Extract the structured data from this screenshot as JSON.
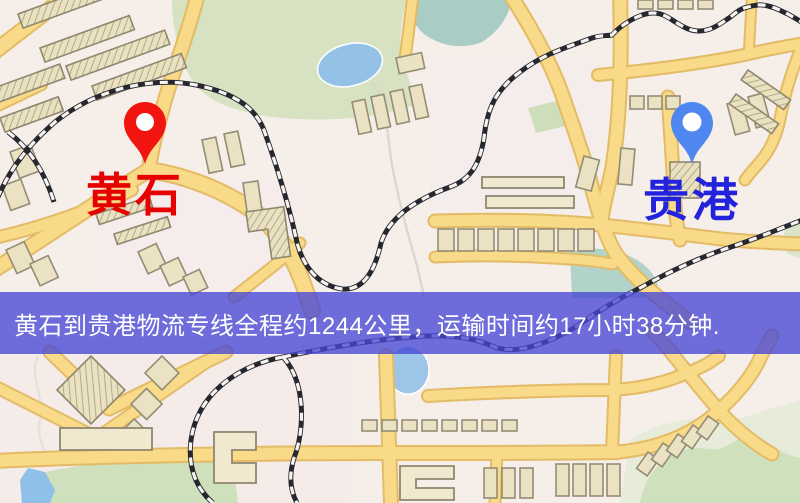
{
  "banner": {
    "text": "黄石到贵港物流专线全程约1244公里，运输时间约17小时38分钟.",
    "background_color": "#4646d6",
    "text_color": "#ffffff"
  },
  "origin": {
    "label": "黄石",
    "pin_color": "#f21410",
    "label_color": "#e60000"
  },
  "destination": {
    "label": "贵港",
    "pin_color": "#4f86f0",
    "label_color": "#2323dd"
  },
  "map_colors": {
    "background": "#f6efe9",
    "road_fill": "#f8da88",
    "road_casing": "#e3bb66",
    "railway_dark": "#27272f",
    "park_green": "#d6e2c2",
    "water_blue": "#93c2e6",
    "building_beige": "#eae2c2"
  }
}
